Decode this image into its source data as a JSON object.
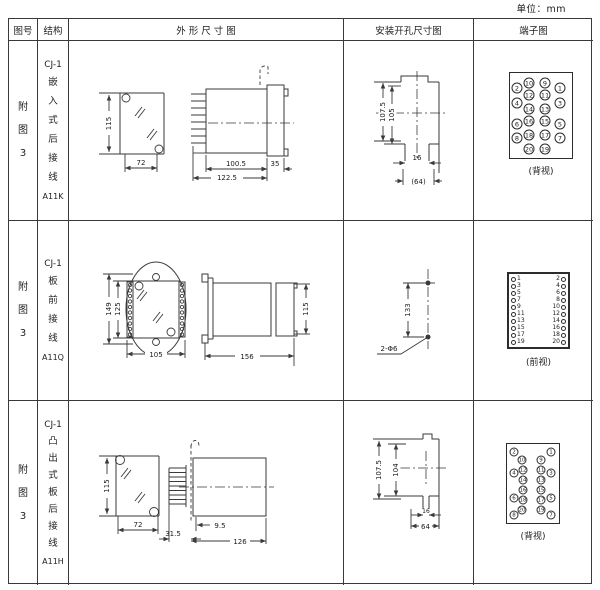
{
  "page": {
    "unit_note": "单位：mm"
  },
  "header": {
    "fig_no": "图号",
    "structure": "结构",
    "outline": "外 形 尺 寸 图",
    "install": "安装开孔尺寸图",
    "terminal": "端子图"
  },
  "rows": [
    {
      "fig": "附图3",
      "model": "CJ-1",
      "desc": "嵌入式后接线",
      "code": "A11K",
      "outline": {
        "d115": "115",
        "d72": "72",
        "d100_5": "100.5",
        "d122_5": "122.5",
        "d35": "35"
      },
      "install": {
        "d107_5": "107.5",
        "d105": "105",
        "d16": "16",
        "d64": "(64)"
      },
      "terminal": {
        "view": "(背视)",
        "circles": [
          {
            "n": "10",
            "x": 19,
            "y": 10
          },
          {
            "n": "9",
            "x": 35,
            "y": 10
          },
          {
            "n": "2",
            "x": 7,
            "y": 15
          },
          {
            "n": "1",
            "x": 50,
            "y": 15
          },
          {
            "n": "12",
            "x": 19,
            "y": 22
          },
          {
            "n": "11",
            "x": 35,
            "y": 22
          },
          {
            "n": "4",
            "x": 7,
            "y": 30
          },
          {
            "n": "3",
            "x": 50,
            "y": 30
          },
          {
            "n": "14",
            "x": 19,
            "y": 36
          },
          {
            "n": "13",
            "x": 35,
            "y": 36
          },
          {
            "n": "16",
            "x": 19,
            "y": 48
          },
          {
            "n": "15",
            "x": 35,
            "y": 48
          },
          {
            "n": "6",
            "x": 7,
            "y": 51
          },
          {
            "n": "5",
            "x": 50,
            "y": 51
          },
          {
            "n": "18",
            "x": 19,
            "y": 62
          },
          {
            "n": "17",
            "x": 35,
            "y": 62
          },
          {
            "n": "8",
            "x": 7,
            "y": 65
          },
          {
            "n": "7",
            "x": 50,
            "y": 65
          },
          {
            "n": "20",
            "x": 19,
            "y": 76
          },
          {
            "n": "19",
            "x": 35,
            "y": 76
          }
        ]
      }
    },
    {
      "fig": "附图3",
      "model": "CJ-1",
      "desc": "板前接线",
      "code": "A11Q",
      "outline": {
        "d149": "149",
        "d125": "125",
        "d105": "105",
        "d156": "156",
        "d115": "115"
      },
      "install": {
        "d133": "133",
        "holes": "2-Φ6"
      },
      "terminal": {
        "view": "(前视)",
        "pairs": [
          [
            "1",
            "2"
          ],
          [
            "3",
            "4"
          ],
          [
            "5",
            "6"
          ],
          [
            "7",
            "8"
          ],
          [
            "9",
            "10"
          ],
          [
            "11",
            "12"
          ],
          [
            "13",
            "14"
          ],
          [
            "15",
            "16"
          ],
          [
            "17",
            "18"
          ],
          [
            "19",
            "20"
          ]
        ]
      }
    },
    {
      "fig": "附图3",
      "model": "CJ-1",
      "desc": "凸出式板后接线",
      "code": "A11H",
      "outline": {
        "d115": "115",
        "d72": "72",
        "d31_5": "31.5",
        "d9_5": "9.5",
        "d126": "126"
      },
      "install": {
        "d107_5": "107.5",
        "d104": "104",
        "d16": "16",
        "d64": "64"
      },
      "terminal": {
        "view": "(背视)",
        "circles": [
          {
            "n": "2",
            "x": 7,
            "y": 8
          },
          {
            "n": "1",
            "x": 44,
            "y": 8
          },
          {
            "n": "10",
            "x": 15,
            "y": 16
          },
          {
            "n": "9",
            "x": 34,
            "y": 16
          },
          {
            "n": "12",
            "x": 16,
            "y": 26
          },
          {
            "n": "11",
            "x": 34,
            "y": 26
          },
          {
            "n": "4",
            "x": 7,
            "y": 29
          },
          {
            "n": "3",
            "x": 44,
            "y": 29
          },
          {
            "n": "14",
            "x": 16,
            "y": 36
          },
          {
            "n": "13",
            "x": 34,
            "y": 36
          },
          {
            "n": "16",
            "x": 16,
            "y": 46
          },
          {
            "n": "15",
            "x": 34,
            "y": 46
          },
          {
            "n": "18",
            "x": 16,
            "y": 56
          },
          {
            "n": "17",
            "x": 34,
            "y": 56
          },
          {
            "n": "6",
            "x": 7,
            "y": 54
          },
          {
            "n": "5",
            "x": 44,
            "y": 54
          },
          {
            "n": "20",
            "x": 15,
            "y": 66
          },
          {
            "n": "19",
            "x": 34,
            "y": 66
          },
          {
            "n": "8",
            "x": 7,
            "y": 71
          },
          {
            "n": "7",
            "x": 44,
            "y": 71
          }
        ]
      }
    }
  ]
}
